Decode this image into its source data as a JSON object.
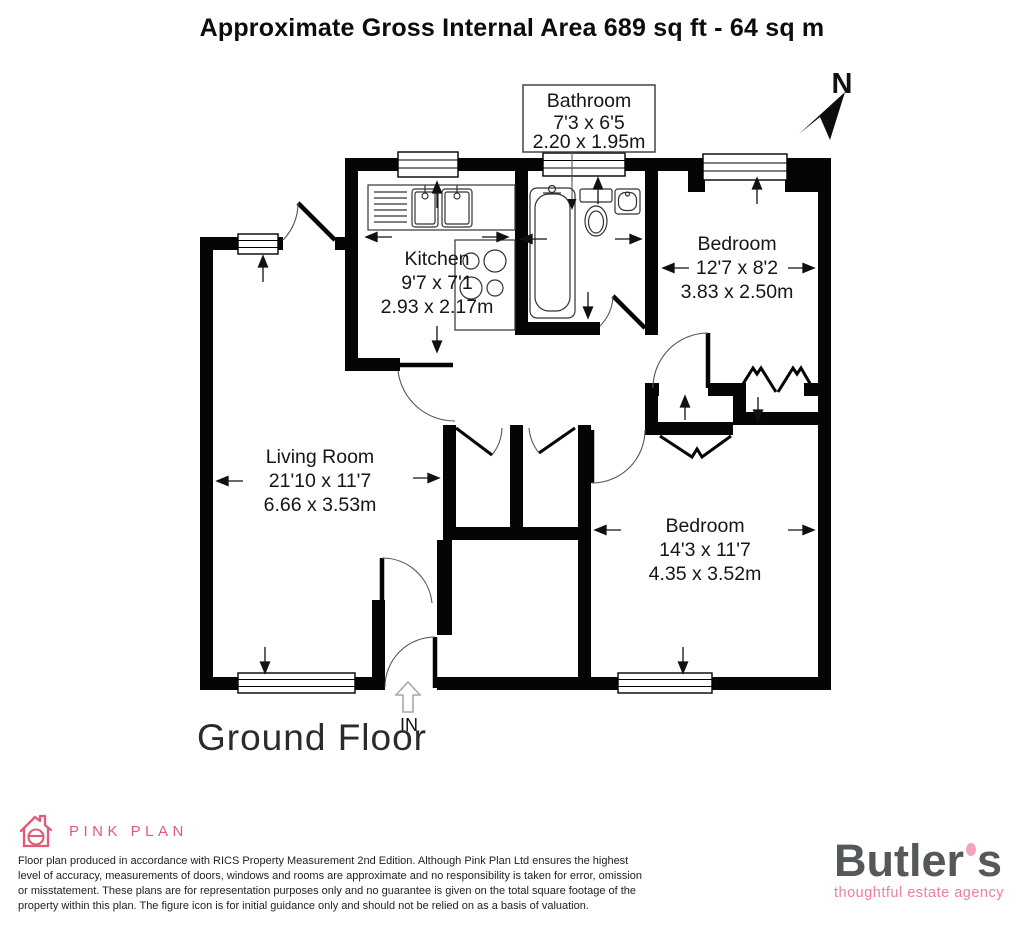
{
  "title": "Approximate Gross Internal Area 689 sq ft - 64 sq m",
  "compass": {
    "label": "N"
  },
  "floor_label": "Ground Floor",
  "entrance_label": "IN",
  "rooms": {
    "bathroom": {
      "name": "Bathroom",
      "imperial": "7'3 x 6'5",
      "metric": "2.20 x 1.95m"
    },
    "kitchen": {
      "name": "Kitchen",
      "imperial": "9'7 x 7'1",
      "metric": "2.93 x 2.17m"
    },
    "bedroom1": {
      "name": "Bedroom",
      "imperial": "12'7 x 8'2",
      "metric": "3.83 x 2.50m"
    },
    "living_room": {
      "name": "Living Room",
      "imperial": "21'10 x 11'7",
      "metric": "6.66 x 3.53m"
    },
    "bedroom2": {
      "name": "Bedroom",
      "imperial": "14'3 x 11'7",
      "metric": "4.35 x 3.52m"
    }
  },
  "footer": {
    "producer_logo_text": "PINK PLAN",
    "disclaimer_lines": [
      "Floor plan produced in accordance with RICS Property Measurement 2nd Edition. Although Pink Plan Ltd ensures the highest",
      "level of accuracy, measurements of doors, windows and rooms are approximate and no responsibility is taken for error, omission",
      "or misstatement. These plans are for representation purposes only and no guarantee is given on the total square footage of the",
      "property within this plan. The figure icon is for initial guidance only and should not be relied on as a basis of valuation."
    ],
    "agency": {
      "name_left": "Butler",
      "name_right": "s",
      "tagline": "thoughtful estate agency"
    }
  },
  "colors": {
    "wall": "#050505",
    "producer_pink": "#e25a76",
    "agency_gray": "#54585b",
    "agency_pink": "#f07e97",
    "agency_apostrophe_pink": "#f2a3b5"
  }
}
